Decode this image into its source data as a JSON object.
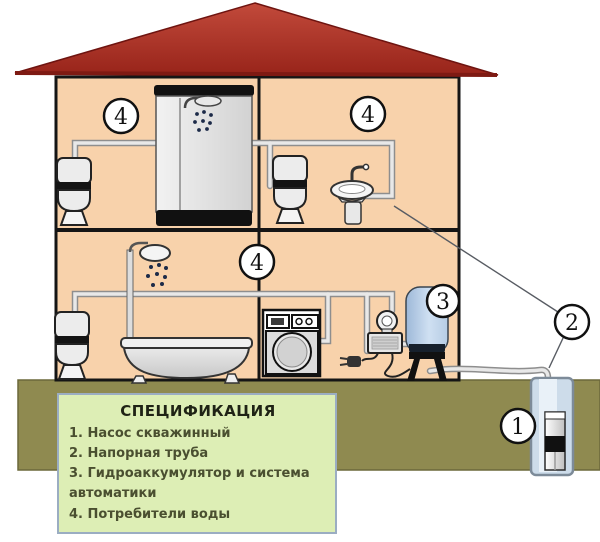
{
  "legend": {
    "title": "СПЕЦИФИКАЦИЯ",
    "items": [
      "1. Насос скважинный",
      "2. Напорная труба",
      "3. Гидроаккумулятор и система автоматики",
      "4. Потребители воды"
    ]
  },
  "markers": {
    "well_pump": "1",
    "pressure_pipe": "2",
    "hydroaccumulator": "3",
    "consumer_floor2_left": "4",
    "consumer_floor2_right": "4",
    "consumer_floor1": "4"
  },
  "colors": {
    "roof_red": "#b03228",
    "wall_fill": "#f8d2ab",
    "outline": "#151515",
    "ground_olive": "#8f8a50",
    "legend_bg": "#ddeeb5",
    "legend_border": "#9badc2",
    "tank_blue": "#b9d0e8",
    "pipe_gray": "#e6e6e6",
    "well_shaft": "#cddcea"
  }
}
